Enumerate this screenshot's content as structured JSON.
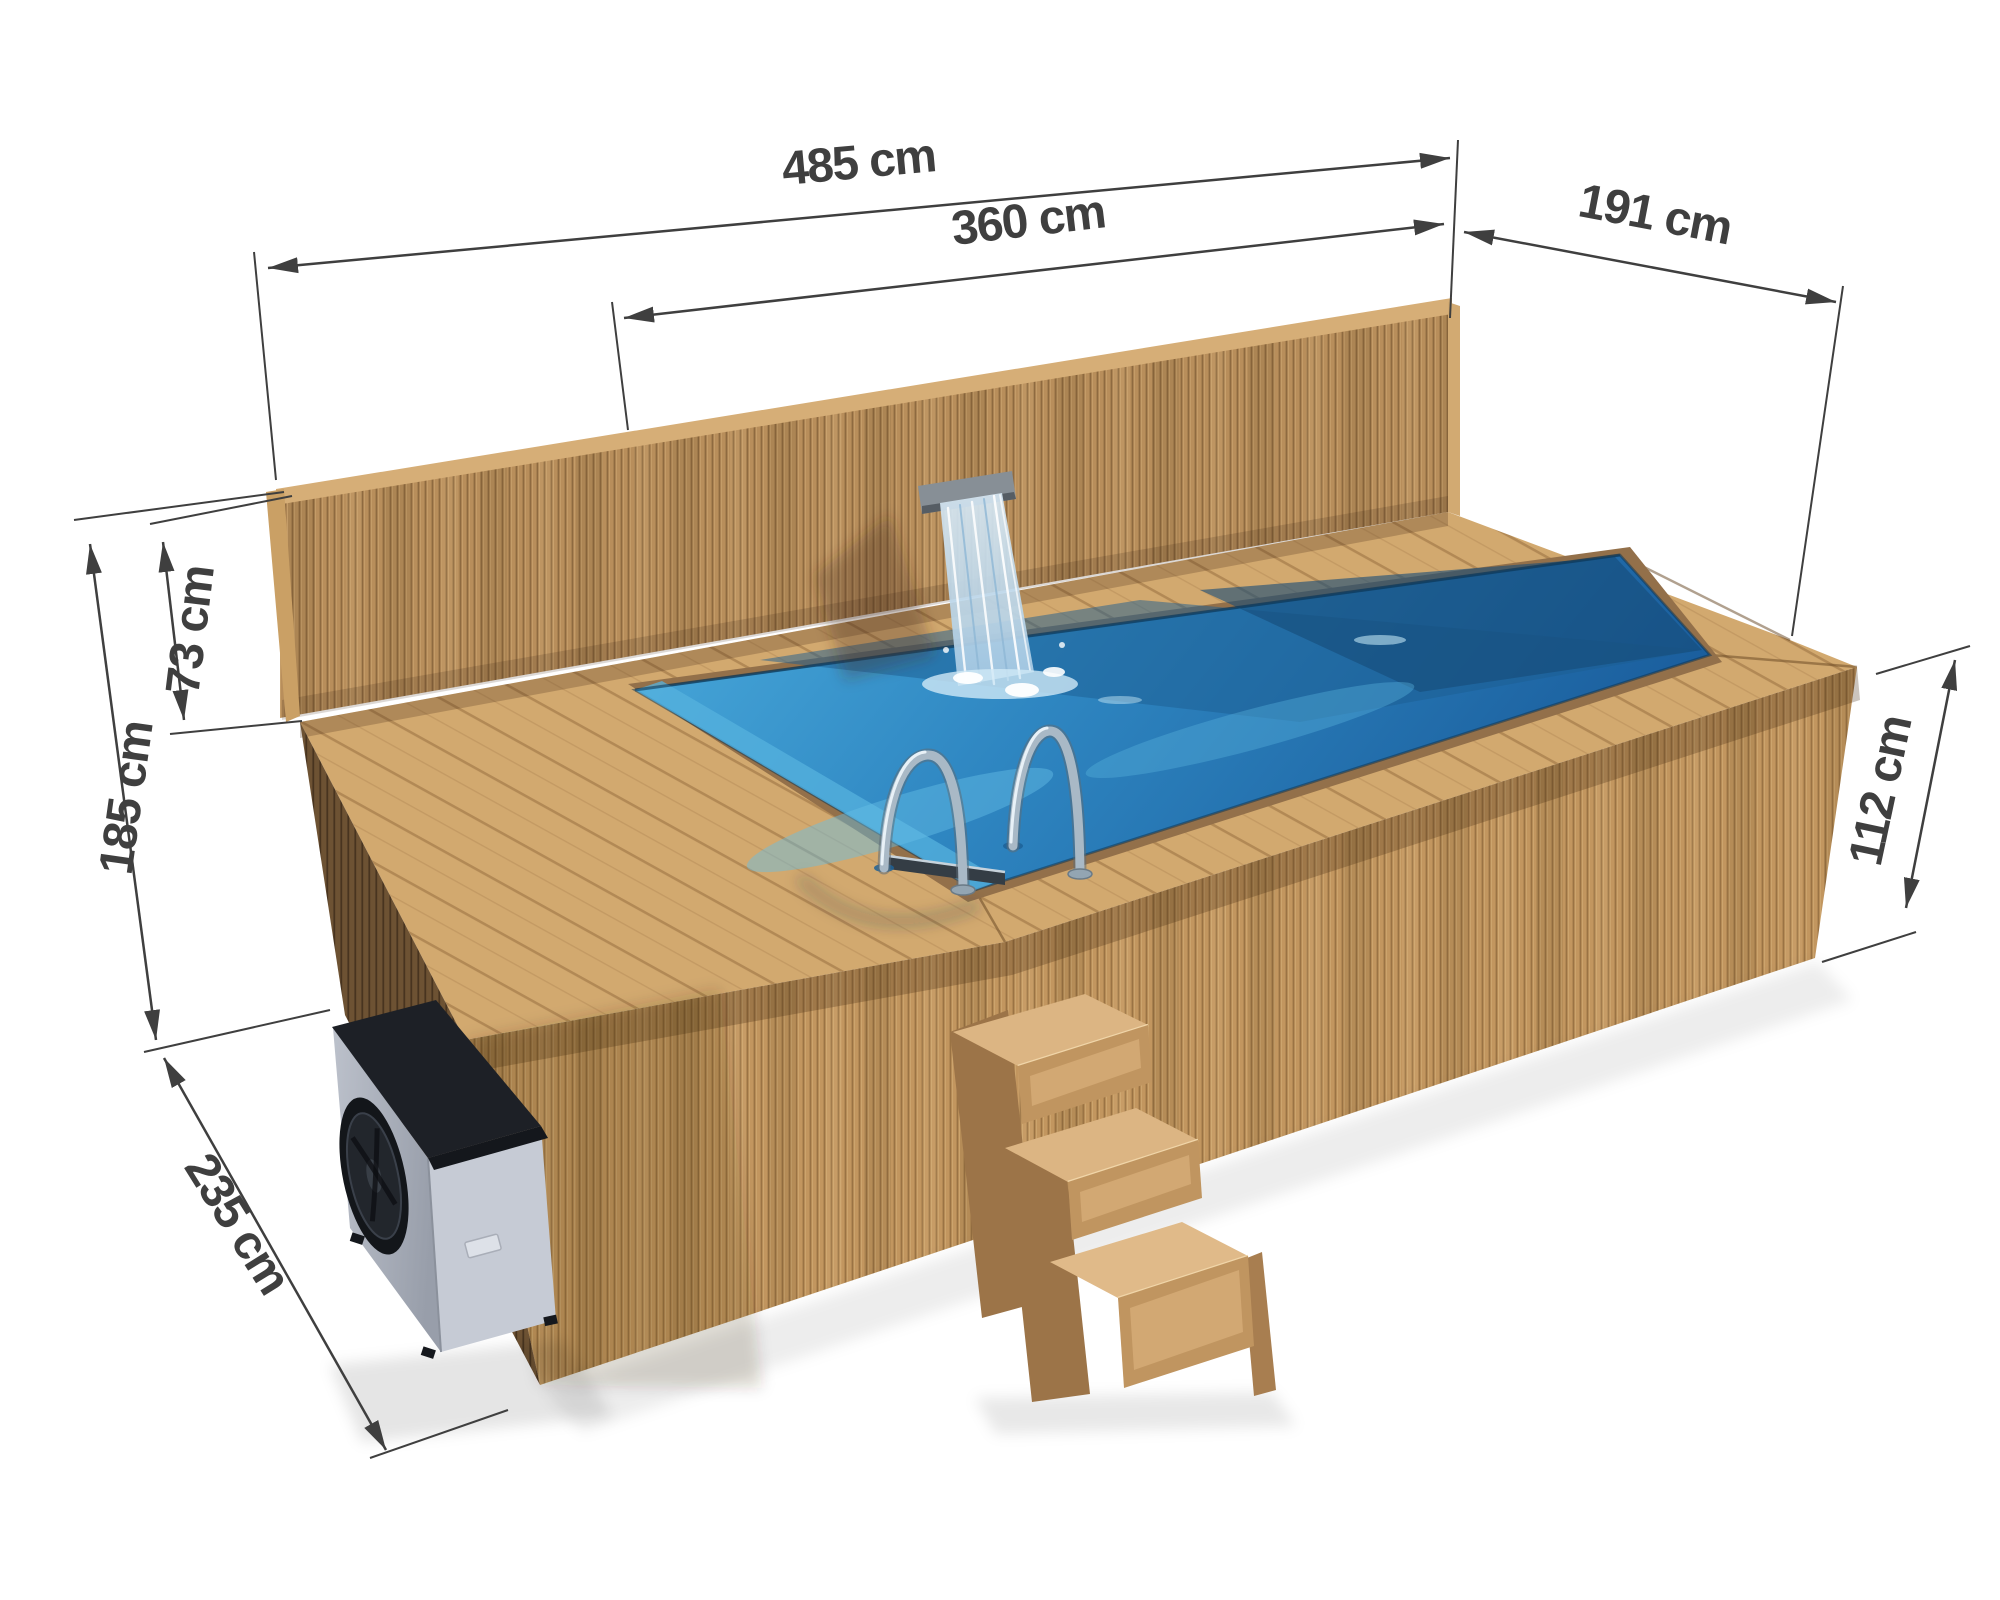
{
  "diagram": {
    "unit": "cm",
    "dimensions": {
      "overall_length": {
        "value": 485,
        "label": "485 cm"
      },
      "inner_length": {
        "value": 360,
        "label": "360 cm"
      },
      "width": {
        "value": 191,
        "label": "191 cm"
      },
      "wall_above_deck": {
        "value": 73,
        "label": "73 cm"
      },
      "total_height": {
        "value": 185,
        "label": "185 cm"
      },
      "ground_depth": {
        "value": 235,
        "label": "235 cm"
      },
      "body_height": {
        "value": 112,
        "label": "112 cm"
      }
    }
  },
  "scene": {
    "objects": [
      "privacy-wall",
      "wooden-deck",
      "pool-water",
      "waterfall-spout",
      "pool-ladder",
      "entry-steps",
      "heat-pump",
      "pool-cabinet"
    ],
    "colors": {
      "wood_light": "#d2a96f",
      "wood_mid": "#c2965f",
      "wood_dark": "#7d5e3b",
      "water_light": "#46a8d8",
      "water_deep": "#1b5f9e",
      "dimension_lines": "#3f3f3f",
      "pump_body": "#c6cbd5",
      "pump_top": "#1d2026"
    }
  }
}
